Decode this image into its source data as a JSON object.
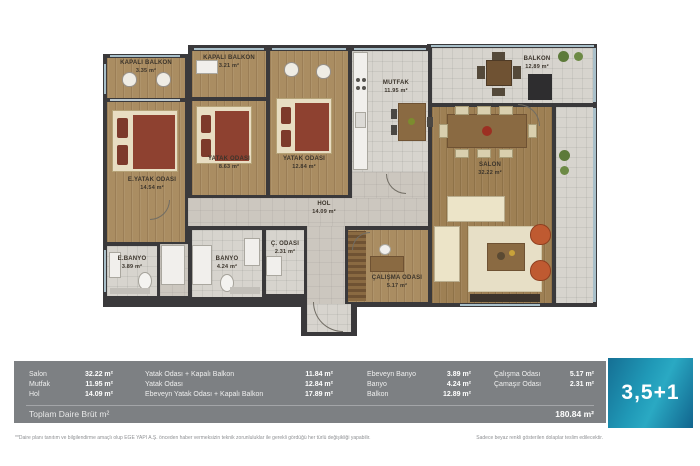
{
  "plan": {
    "rooms": [
      {
        "name": "kapali-balkon-1",
        "label": "KAPALI BALKON",
        "area": "3.35 m²"
      },
      {
        "name": "kapali-balkon-2",
        "label": "KAPALI BALKON",
        "area": "3.21 m²"
      },
      {
        "name": "yatak-odasi-kucuk",
        "label": "YATAK ODASI",
        "area": "8.63 m²"
      },
      {
        "name": "yatak-odasi",
        "label": "YATAK ODASI",
        "area": "12.84 m²"
      },
      {
        "name": "ebeveyn-yatak-odasi",
        "label": "E.YATAK ODASI",
        "area": "14.54 m²"
      },
      {
        "name": "mutfak",
        "label": "MUTFAK",
        "area": "11.95 m²"
      },
      {
        "name": "balkon",
        "label": "BALKON",
        "area": "12.89 m²"
      },
      {
        "name": "salon",
        "label": "SALON",
        "area": "32.22 m²"
      },
      {
        "name": "hol",
        "label": "HOL",
        "area": "14.09 m²"
      },
      {
        "name": "ebeveyn-banyo",
        "label": "E.BANYO",
        "area": "3.89 m²"
      },
      {
        "name": "banyo",
        "label": "BANYO",
        "area": "4.24 m²"
      },
      {
        "name": "camasir-odasi",
        "label": "Ç. ODASI",
        "area": "2.31 m²"
      },
      {
        "name": "calisma-odasi",
        "label": "ÇALIŞMA ODASI",
        "area": "5.17 m²"
      }
    ]
  },
  "summary": {
    "col1": [
      {
        "label": "Salon",
        "value": "32.22 m²"
      },
      {
        "label": "Mutfak",
        "value": "11.95 m²"
      },
      {
        "label": "Hol",
        "value": "14.09 m²"
      }
    ],
    "col2": [
      {
        "label": "Yatak Odası + Kapalı Balkon",
        "value": "11.84 m²"
      },
      {
        "label": "Yatak Odası",
        "value": "12.84 m²"
      },
      {
        "label": "Ebeveyn Yatak Odası + Kapalı Balkon",
        "value": "17.89 m²"
      }
    ],
    "col3": [
      {
        "label": "Ebeveyn Banyo",
        "value": "3.89 m²"
      },
      {
        "label": "Banyo",
        "value": "4.24 m²"
      },
      {
        "label": "Balkon",
        "value": "12.89 m²"
      }
    ],
    "col4": [
      {
        "label": "Çalışma Odası",
        "value": "5.17 m²"
      },
      {
        "label": "Çamaşır Odası",
        "value": "2.31 m²"
      }
    ],
    "total_label": "Toplam Daire Brüt m²",
    "total_value": "180.84 m²"
  },
  "badge": {
    "label": "3,5+1"
  },
  "footnotes": {
    "left": "**Daire planı tanıtım ve bilgilendirme amaçlı olup EGE YAPI A.Ş. önceden haber vermeksizin teknik zorunluluklar ile gerekli gördüğü her türlü değişikliği yapabilir.",
    "right": "Sadece beyaz renkli gösterilen dolaplar teslim edilecektir."
  },
  "colors": {
    "accent_teal": "#2099b7",
    "band_gray": "#7d8083",
    "wall": "#3a393b",
    "wood": "#aa8d62",
    "tile": "#d7d4ce",
    "bed_maroon": "#8e4130",
    "armchair_rust": "#bf5a31"
  }
}
